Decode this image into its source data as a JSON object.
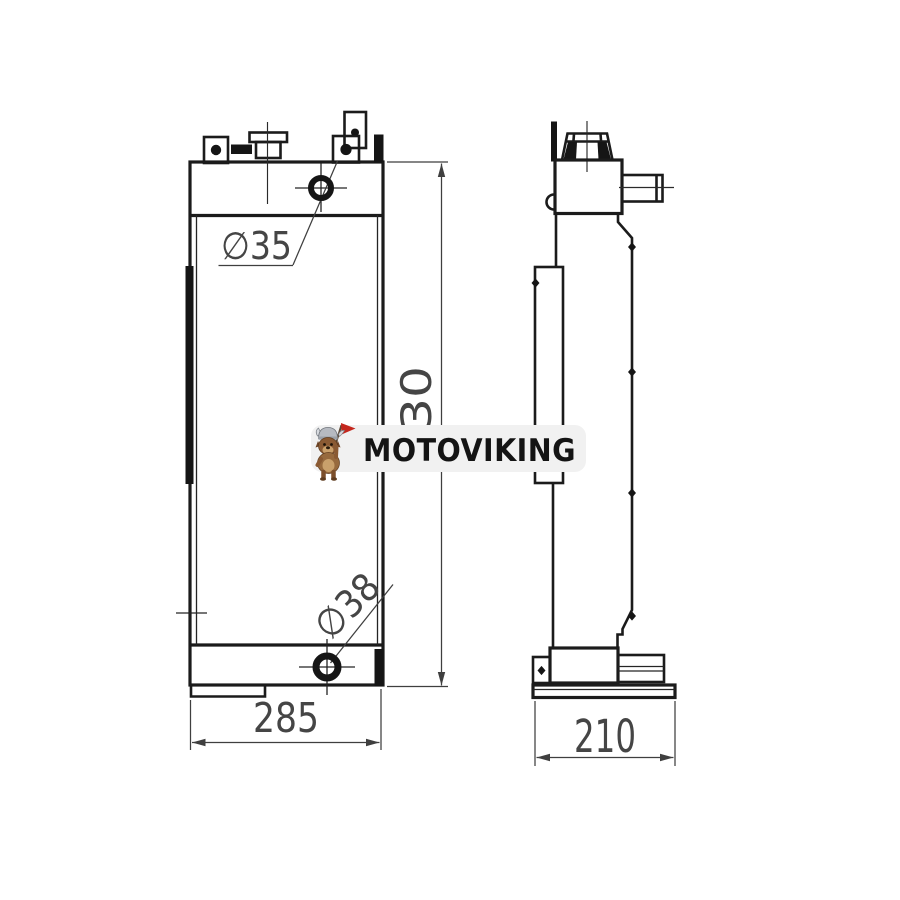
{
  "drawing": {
    "type": "radiator-2-view-technical-drawing",
    "line_color": "#1b1b1b",
    "dim_color": "#454545",
    "background": "#ffffff"
  },
  "front_view": {
    "top_port_diameter": "∅35",
    "bottom_port_diameter": "∅38",
    "width_dim": "285",
    "height_dim": "730"
  },
  "side_view": {
    "depth_dim": "210"
  },
  "watermark": {
    "brand": "MOTOVIKING",
    "mascot_icon": "viking-dog-with-flag",
    "band_color": "#f1f1f1",
    "text_color": "#141414",
    "flag_color": "#c4271d"
  }
}
